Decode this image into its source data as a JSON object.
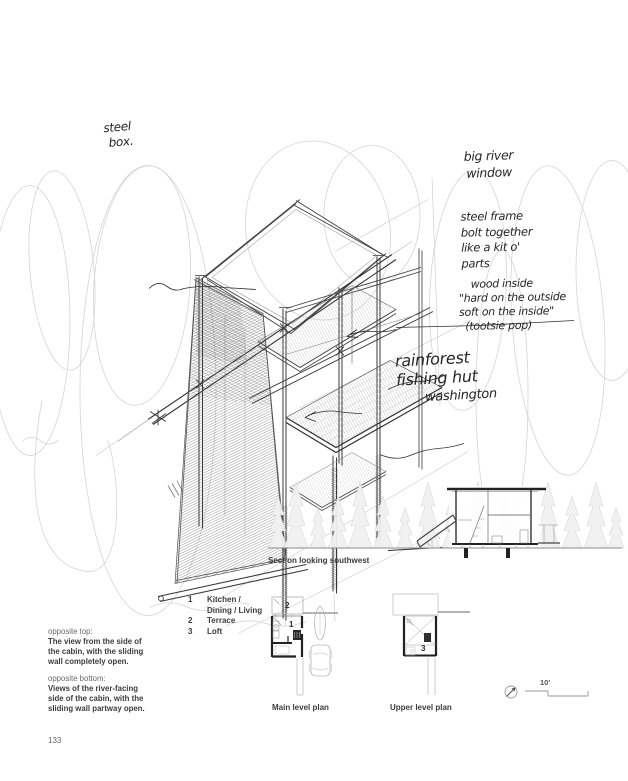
{
  "page_number": "133",
  "colors": {
    "paper": "#ffffff",
    "pencil_dark": "#2f2f2f",
    "pencil_light": "#c7c7c7",
    "plan_wall": "#222222",
    "plan_light_grey": "#b5b5b5",
    "print_text": "#3c3c3c"
  },
  "annotations": {
    "steel_box": [
      "steel",
      "box."
    ],
    "big_river": [
      "big river",
      "window"
    ],
    "steel_frame": [
      "steel frame",
      "bolt together",
      "like a kit o'",
      "parts"
    ],
    "wood": [
      "wood inside",
      "\"hard on the outside",
      "soft on the inside\"",
      "(tootsie pop)"
    ],
    "title": [
      "rainforest",
      "fishing hut",
      "washington"
    ]
  },
  "section": {
    "caption": "Section looking southwest"
  },
  "legend": {
    "rows": [
      {
        "num": "1",
        "label": "Kitchen /"
      },
      {
        "num": "",
        "label": "Dining / Living"
      },
      {
        "num": "2",
        "label": "Terrace"
      },
      {
        "num": "3",
        "label": "Loft"
      }
    ]
  },
  "plans": {
    "main": {
      "caption": "Main level plan",
      "terrace_num": "2",
      "room_num": "1"
    },
    "upper": {
      "caption": "Upper level plan",
      "loft_num": "3"
    },
    "scale_label": "10'"
  },
  "captions_left": {
    "top_label": "opposite top:",
    "top_lines": [
      "The view from the side of",
      "the cabin, with the sliding",
      "wall completely open."
    ],
    "bottom_label": "opposite bottom:",
    "bottom_lines": [
      "Views of the river-facing",
      "side of the cabin, with the",
      "sliding wall partway open."
    ]
  }
}
